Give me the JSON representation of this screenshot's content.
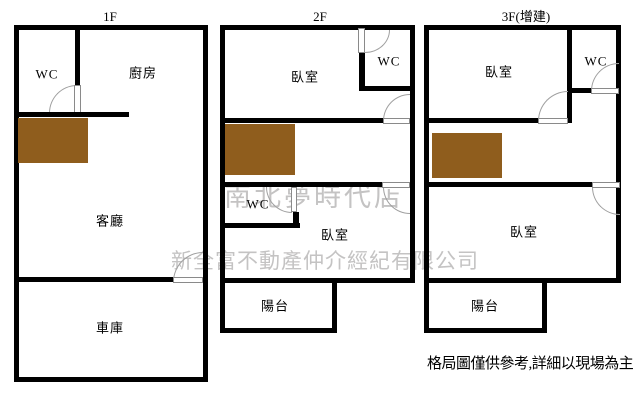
{
  "floors": {
    "f1": {
      "title": "1F",
      "wc": "WC",
      "kitchen": "廚房",
      "living": "客廳",
      "garage": "車庫"
    },
    "f2": {
      "title": "2F",
      "bedroom_upper": "臥室",
      "wc_upper": "WC",
      "wc_lower": "WC",
      "bedroom_lower": "臥室",
      "balcony": "陽台"
    },
    "f3": {
      "title": "3F(增建)",
      "bedroom_upper": "臥室",
      "wc": "WC",
      "bedroom_lower": "臥室",
      "balcony": "陽台"
    }
  },
  "watermark": {
    "line1": "南北夢時代店",
    "line2": "新全富不動產仲介經紀有限公司"
  },
  "footnote": "格局圖僅供參考,詳細以現場為主",
  "colors": {
    "background": "#ffffff",
    "wall": "#000000",
    "stair_block": "#8f5d1d",
    "watermark": "#c4c3c3",
    "door_line": "#a0a0a0"
  }
}
